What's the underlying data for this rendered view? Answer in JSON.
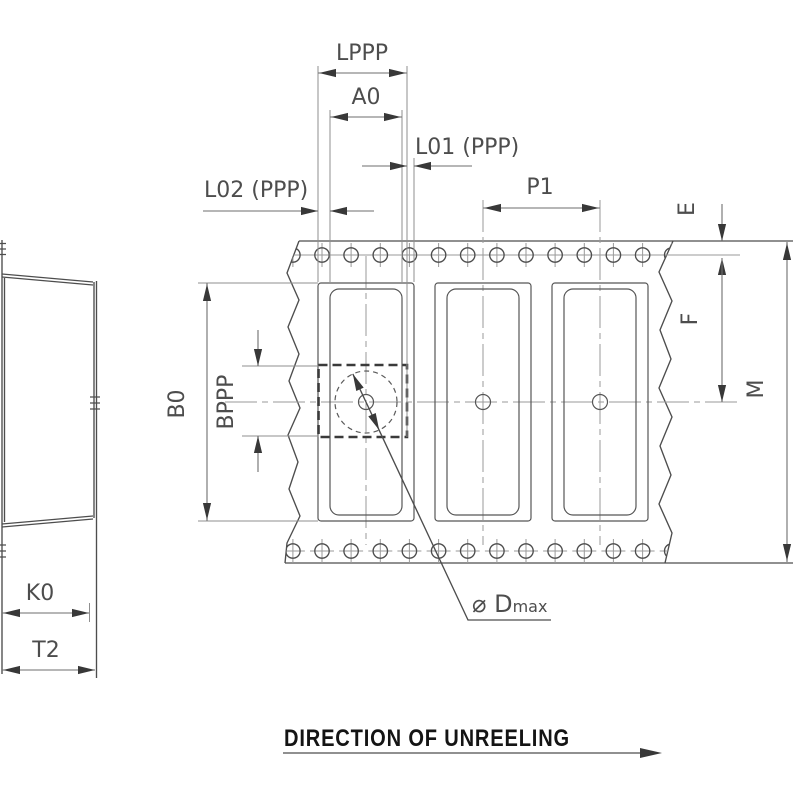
{
  "drawing": {
    "dimension_labels": {
      "lppp": "LPPP",
      "a0": "A0",
      "l01": "L01 (PPP)",
      "l02": "L02 (PPP)",
      "p1": "P1",
      "e": "E",
      "f": "F",
      "m": "M",
      "b0": "B0",
      "bppp": "BPPP",
      "k0": "K0",
      "t2": "T2"
    },
    "hole_diameter_label": {
      "symbol": "⌀ D",
      "subscript": "max"
    },
    "footer": {
      "direction_text": "DIRECTION OF UNREELING"
    },
    "colors": {
      "background": "#ffffff",
      "drawing_line": "#4d4d4d",
      "dimension_line": "#6e6e6e",
      "extension_line": "#8f8f8f",
      "centerline": "#9a9a9a",
      "arrow": "#383838",
      "label_text": "#4d4d4d",
      "footer_text": "#141414"
    }
  }
}
